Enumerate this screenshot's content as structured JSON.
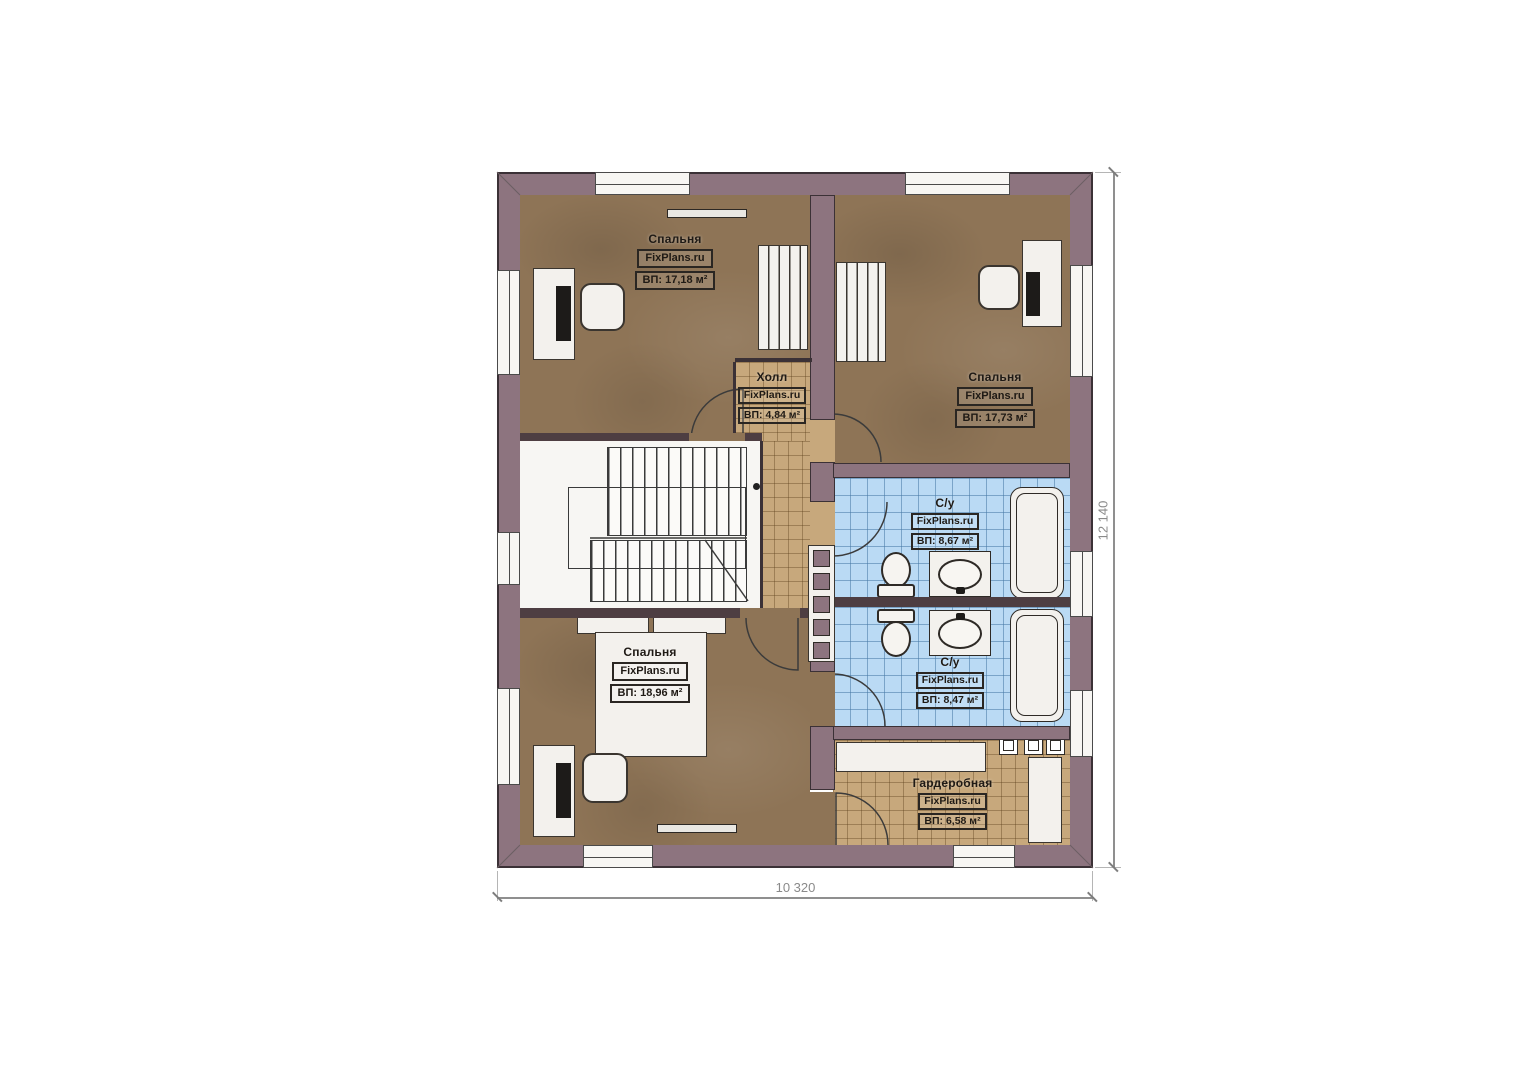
{
  "plan": {
    "rooms": [
      {
        "id": "bedroom-top-left",
        "name": "Спальня",
        "watermark": "FixPlans.ru",
        "area": "ВП: 17,18 м²"
      },
      {
        "id": "hall",
        "name": "Холл",
        "watermark": "FixPlans.ru",
        "area": "ВП: 4,84 м²"
      },
      {
        "id": "bedroom-top-right",
        "name": "Спальня",
        "watermark": "FixPlans.ru",
        "area": "ВП: 17,73 м²"
      },
      {
        "id": "bathroom-top",
        "name": "С/у",
        "watermark": "FixPlans.ru",
        "area": "ВП: 8,67 м²"
      },
      {
        "id": "bathroom-bottom",
        "name": "С/у",
        "watermark": "FixPlans.ru",
        "area": "ВП: 8,47 м²"
      },
      {
        "id": "bedroom-bottom",
        "name": "Спальня",
        "watermark": "FixPlans.ru",
        "area": "ВП: 18,96 м²"
      },
      {
        "id": "wardrobe",
        "name": "Гардеробная",
        "watermark": "FixPlans.ru",
        "area": "ВП: 6,58 м²"
      }
    ],
    "dimensions": {
      "width": "10 320",
      "height": "12 140"
    },
    "colors": {
      "wall": "#8d747f",
      "wall_outline": "#3b3136",
      "bedroom_floor": "#8e7456",
      "bath_tile": "#badaf4",
      "hall_tile": "#c7a87c",
      "stair_fill": "#f7f6f3",
      "dimension_text": "#8a8a8a"
    }
  }
}
